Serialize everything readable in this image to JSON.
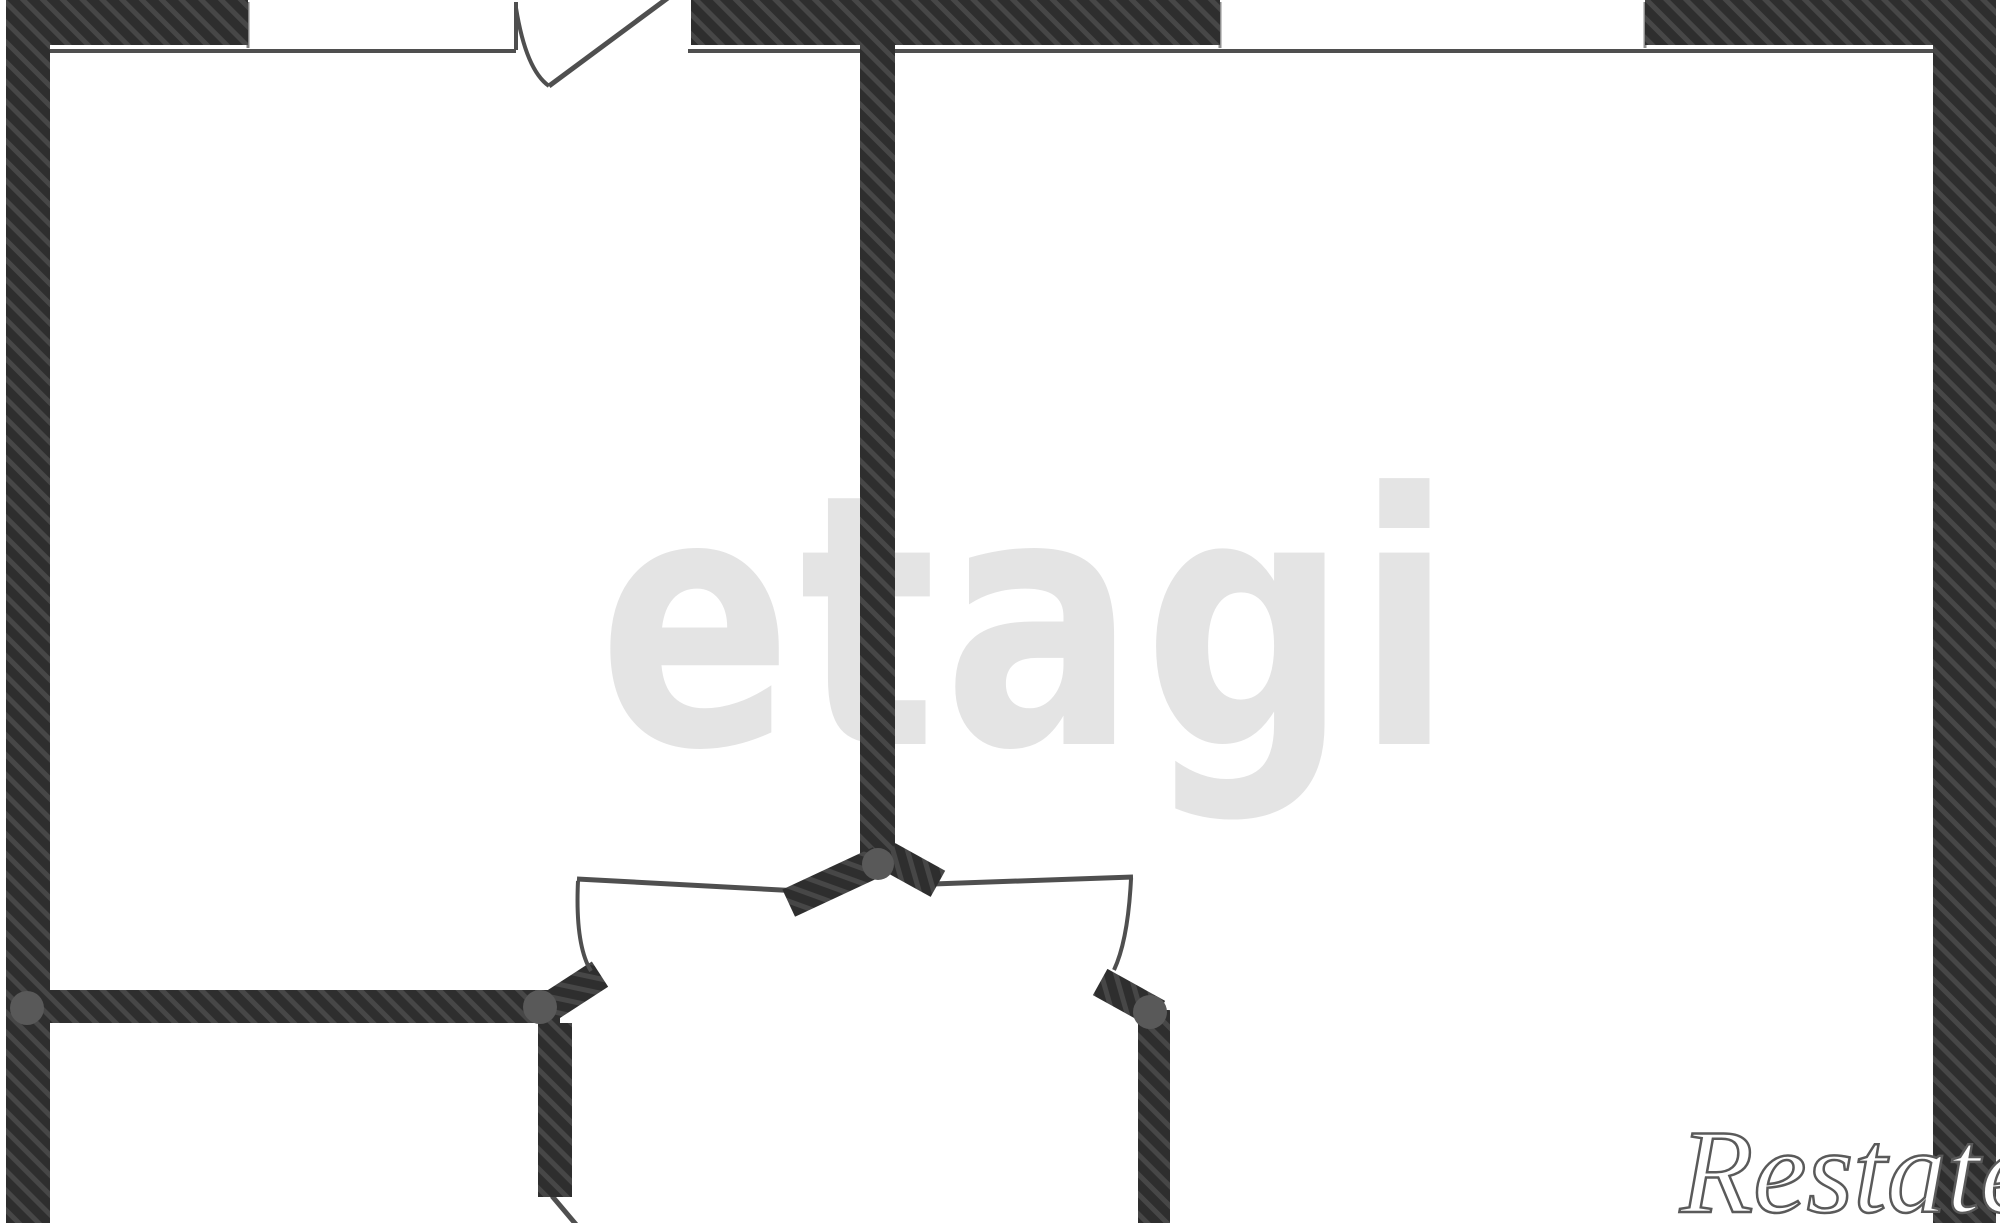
{
  "watermarks": {
    "center_logo": "etagi",
    "corner_logo": "Restate"
  },
  "colors": {
    "background": "#ffffff",
    "wall_dark": "#2e2e2e",
    "wall_stripe": "#474747",
    "line": "#4f4f4f",
    "window_edge": "#848484",
    "dot": "#595959",
    "watermark_center": "#e4e4e4",
    "watermark_corner_fill": "#ffffff",
    "watermark_corner_outline": "#5a5a5a"
  },
  "plan": {
    "canvas": {
      "w": 2000,
      "h": 1223
    },
    "hatched_rects": [
      {
        "name": "left-exterior-wall",
        "x": 6,
        "y": 0,
        "w": 44,
        "h": 1223
      },
      {
        "name": "right-exterior-wall",
        "x": 1933,
        "y": 0,
        "w": 63,
        "h": 1223
      },
      {
        "name": "top-wall-left-segment",
        "x": 6,
        "y": 0,
        "w": 242,
        "h": 45
      },
      {
        "name": "top-wall-middle-segment",
        "x": 691,
        "y": 0,
        "w": 529,
        "h": 45
      },
      {
        "name": "top-wall-right-segment",
        "x": 1645,
        "y": 0,
        "w": 351,
        "h": 45
      },
      {
        "name": "interior-wall-vertical",
        "x": 860,
        "y": 45,
        "w": 35,
        "h": 820
      },
      {
        "name": "interior-wall-left-horizontal",
        "x": 50,
        "y": 990,
        "w": 510,
        "h": 33
      },
      {
        "name": "lower-left-wall-vertical",
        "x": 538,
        "y": 1023,
        "w": 34,
        "h": 174
      },
      {
        "name": "lower-right-wall-vertical",
        "x": 1138,
        "y": 1010,
        "w": 32,
        "h": 213
      }
    ],
    "rotated_walls": [
      {
        "name": "junction-arm-left",
        "cx": 834,
        "cy": 882,
        "len": 100,
        "th": 30,
        "angle": -25
      },
      {
        "name": "junction-arm-right",
        "cx": 913,
        "cy": 870,
        "len": 57,
        "th": 30,
        "angle": 29
      },
      {
        "name": "left-doorway-jamb",
        "cx": 574,
        "cy": 991,
        "len": 62,
        "th": 30,
        "angle": -33
      },
      {
        "name": "right-doorway-jamb",
        "cx": 1129,
        "cy": 998,
        "len": 66,
        "th": 30,
        "angle": 29
      }
    ],
    "lines": [
      {
        "name": "top-wall-inner-face-left",
        "x1": 50,
        "y1": 51,
        "x2": 516,
        "y2": 51,
        "w": 4
      },
      {
        "name": "top-wall-inner-face-right",
        "x1": 688,
        "y1": 51,
        "x2": 1933,
        "y2": 51,
        "w": 4
      },
      {
        "name": "entry-door-frame",
        "x1": 516,
        "y1": 2,
        "x2": 516,
        "y2": 50,
        "w": 4
      },
      {
        "name": "window-left-edge",
        "x1": 248,
        "y1": 2,
        "x2": 248,
        "y2": 48,
        "w": 3,
        "color": "#848484"
      },
      {
        "name": "window2-left-edge",
        "x1": 1220,
        "y1": 2,
        "x2": 1220,
        "y2": 48,
        "w": 3,
        "color": "#8f8f8f"
      },
      {
        "name": "window2-right-edge",
        "x1": 1645,
        "y1": 2,
        "x2": 1645,
        "y2": 48,
        "w": 3,
        "color": "#8f8f8f"
      },
      {
        "name": "entry-door-leaf",
        "x1": 549,
        "y1": 86,
        "x2": 684,
        "y2": -14,
        "w": 5
      },
      {
        "name": "hall-left-doorway-header",
        "x1": 577,
        "y1": 879,
        "x2": 800,
        "y2": 891,
        "w": 5
      },
      {
        "name": "hall-right-doorway-header",
        "x1": 933,
        "y1": 884,
        "x2": 1133,
        "y2": 877,
        "w": 5
      },
      {
        "name": "lower-left-door-leaf",
        "x1": 552,
        "y1": 1196,
        "x2": 579,
        "y2": 1228,
        "w": 5
      }
    ],
    "curves": [
      {
        "name": "entry-door-arc",
        "d": "M 516 8 Q 526 70 549 86"
      },
      {
        "name": "hall-left-door-leaf",
        "d": "M 578 881 Q 575 945 591 971"
      },
      {
        "name": "hall-right-door-leaf",
        "d": "M 1131 879 Q 1128 940 1114 970"
      }
    ],
    "dots": [
      {
        "name": "joint-dot-left-wall",
        "cx": 27,
        "cy": 1008,
        "r": 17
      },
      {
        "name": "joint-dot-left-doorway",
        "cx": 540,
        "cy": 1007,
        "r": 17
      },
      {
        "name": "joint-dot-wall-junction",
        "cx": 878,
        "cy": 864,
        "r": 16
      },
      {
        "name": "joint-dot-right-doorway",
        "cx": 1150,
        "cy": 1012,
        "r": 17
      }
    ]
  }
}
